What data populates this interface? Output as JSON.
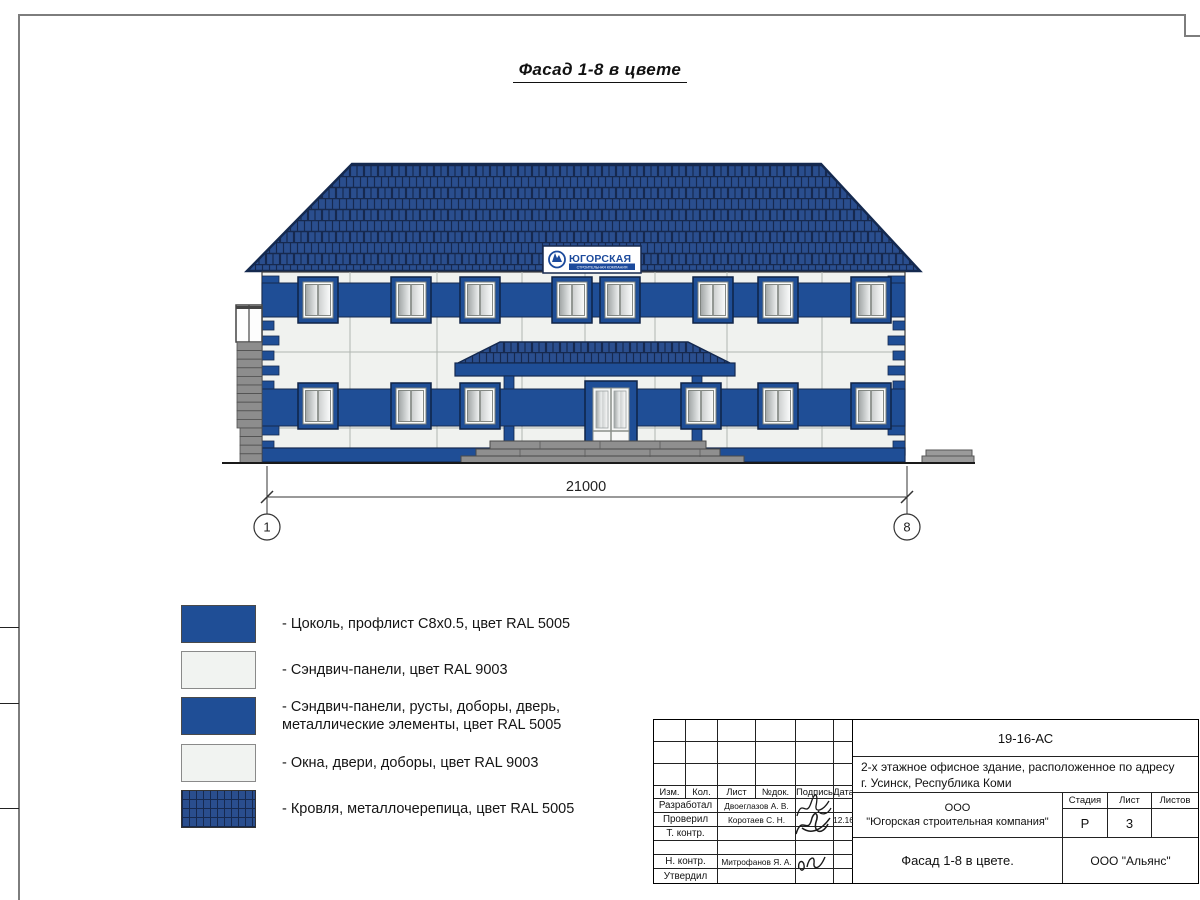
{
  "sheet": {
    "title": "Фасад 1-8 в цвете",
    "dimension": "21000",
    "axis_left": "1",
    "axis_right": "8"
  },
  "sign": {
    "name": "ЮГОРСКАЯ",
    "subtitle": "СТРОИТЕЛЬНАЯ КОМПАНИЯ"
  },
  "watermark": {
    "text": "АЛЬЯНС"
  },
  "legend": {
    "items": [
      {
        "swatch": "blue",
        "label": "- Цоколь, профлист С8х0.5, цвет RAL 5005",
        "label2": ""
      },
      {
        "swatch": "white",
        "label": "- Сэндвич-панели, цвет RAL 9003",
        "label2": ""
      },
      {
        "swatch": "blue",
        "label": "- Сэндвич-панели, русты, доборы, дверь,",
        "label2": "металлические элементы, цвет RAL 5005"
      },
      {
        "swatch": "white",
        "label": "- Окна, двери, доборы, цвет RAL 9003",
        "label2": ""
      },
      {
        "swatch": "roof",
        "label": "- Кровля, металлочерепица, цвет RAL 5005",
        "label2": ""
      }
    ]
  },
  "title_block": {
    "doc_number": "19-16-АС",
    "project_line1": "2-х этажное офисное здание, расположенное по адресу",
    "project_line2": "г. Усинск, Республика Коми",
    "columns": [
      "Изм.",
      "Кол.",
      "Лист",
      "№док.",
      "Подпись",
      "Дата"
    ],
    "rows": [
      {
        "role": "Разработал",
        "name": "Двоеглазов А. В.",
        "date": ""
      },
      {
        "role": "Проверил",
        "name": "Коротаев С. Н.",
        "date": "12.16"
      },
      {
        "role": "Т. контр.",
        "name": "",
        "date": ""
      },
      {
        "role": "",
        "name": "",
        "date": ""
      },
      {
        "role": "Н. контр.",
        "name": "Митрофанов Я. А.",
        "date": ""
      },
      {
        "role": "Утвердил",
        "name": "",
        "date": ""
      }
    ],
    "company_line1": "ООО",
    "company_line2": "\"Югорская строительная компания\"",
    "stage_header": "Стадия",
    "sheet_header": "Лист",
    "sheets_header": "Листов",
    "stage": "Р",
    "sheet_no": "3",
    "sheets_total": "",
    "drawing_title": "Фасад 1-8 в цвете.",
    "org": "ООО \"Альянс\""
  },
  "colors": {
    "band_blue": "#1f4e96",
    "roof_blue": "#2a4e8e",
    "roof_line": "#16294f",
    "wall_white": "#f0f2ef",
    "step_gray": "#8f8f8f"
  }
}
